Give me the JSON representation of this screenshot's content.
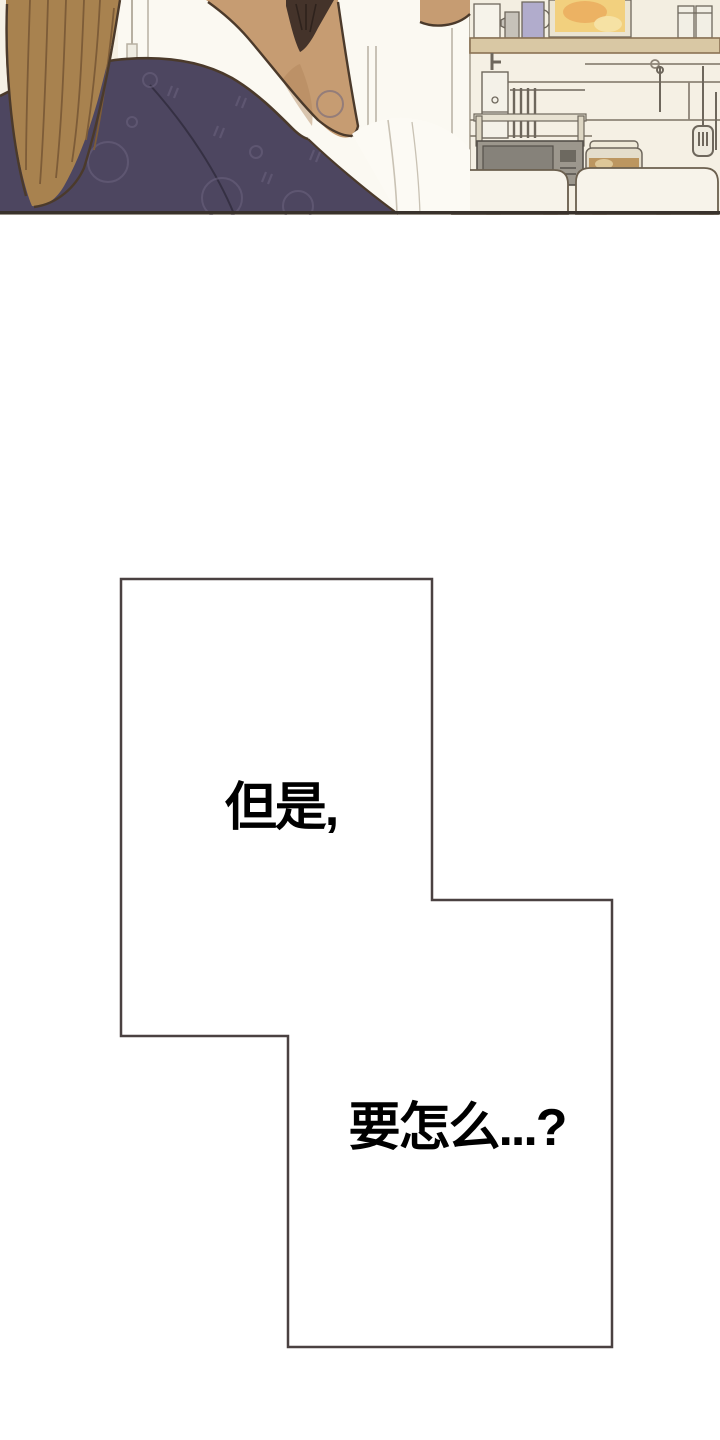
{
  "page": {
    "background": "#ffffff"
  },
  "panel": {
    "description": "webtoon panel: person seen from behind (long brown hair, dark navy patterned garment) in a cream kitchen with wooden shelf, bottles, picture, hanging utensils, microwave, rice cooker and white chairs",
    "colors": {
      "wall": "#f5f0e4",
      "cabinet": "#fbf9f2",
      "cabinet-line": "#b7b0a2",
      "outline-dark": "#4b3a2b",
      "hair": "#a8824f",
      "hair-shadow": "#7d5c38",
      "hair-dark": "#44332a",
      "skin": "#c69c72",
      "skin-shadow": "#b0855c",
      "garment": "#4d4660",
      "garment-pattern": "#6c6480",
      "shirt": "#fcfaf4",
      "shirt-line": "#c9c2b4",
      "shelf-wood": "#d9c8a4",
      "shelf-edge": "#8a7254",
      "line-gray": "#8d8477",
      "metal": "#c6c2b9",
      "metal-dark": "#6e675c",
      "picture-frame": "#ebe4d1",
      "picture-yellow": "#f2d07e",
      "picture-orange": "#e9a85b",
      "pitcher": "#b1accc",
      "canister": "#f2efe5",
      "microwave": "#9c978d",
      "microwave-door": "#86827a",
      "microwave-screen": "#6d6960",
      "cooker-body": "#e4ddcb",
      "cooker-lid": "#efe9d8",
      "cooker-amber": "#b5894e",
      "chair": "#f7f3ea",
      "chair-edge": "#6b5f4e",
      "chair-leg": "#d9b77d",
      "chair-leg-edge": "#8a6f48",
      "panel-border": "#39322c"
    }
  },
  "speech_bubble": {
    "line1": "但是,",
    "line2": "要怎么...?",
    "fill": "#ffffff",
    "outline": "#4a4141",
    "text_color": "#000000"
  }
}
